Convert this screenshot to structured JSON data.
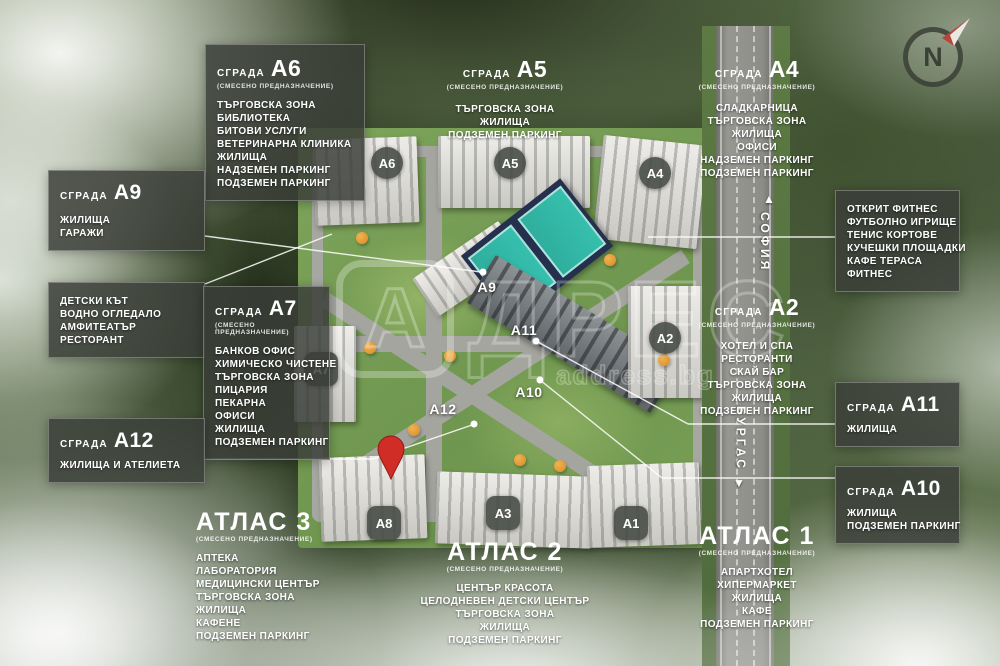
{
  "brand": {
    "logo_letter": "А",
    "watermark_rest": "ДРЕС",
    "watermark_domain": "address.bg",
    "compass_letter": "N"
  },
  "road": {
    "to_sofia": "СОФИЯ",
    "to_burgas": "БУРГАС",
    "sofia_arrow": "▲",
    "burgas_arrow": "▼"
  },
  "colors": {
    "pin_red": "#cf2d26",
    "panel_bg": "rgba(58,62,56,0.84)",
    "court_teal": "#2fae9d"
  },
  "markers": {
    "badges": [
      "A6",
      "A5",
      "A4",
      "A2",
      "A7",
      "A8",
      "A3",
      "A1"
    ],
    "labels": [
      "A9",
      "A11",
      "A10",
      "A12"
    ]
  },
  "panels": {
    "a6": {
      "kicker": "СГРАДА",
      "code": "A6",
      "note": "(СМЕСЕНО ПРЕДНАЗНАЧЕНИЕ)",
      "items": [
        "ТЪРГОВСКА ЗОНА",
        "БИБЛИОТЕКА",
        "БИТОВИ УСЛУГИ",
        "ВЕТЕРИНАРНА КЛИНИКА",
        "ЖИЛИЩА",
        "НАДЗЕМЕН ПАРКИНГ",
        "ПОДЗЕМЕН ПАРКИНГ"
      ]
    },
    "a5": {
      "kicker": "СГРАДА",
      "code": "A5",
      "note": "(СМЕСЕНО ПРЕДНАЗНАЧЕНИЕ)",
      "items": [
        "ТЪРГОВСКА ЗОНА",
        "ЖИЛИЩА",
        "ПОДЗЕМЕН ПАРКИНГ"
      ]
    },
    "a4": {
      "kicker": "СГРАДА",
      "code": "A4",
      "note": "(СМЕСЕНО ПРЕДНАЗНАЧЕНИЕ)",
      "items": [
        "СЛАДКАРНИЦА",
        "ТЪРГОВСКА ЗОНА",
        "ЖИЛИЩА",
        "ОФИСИ",
        "НАДЗЕМЕН ПАРКИНГ",
        "ПОДЗЕМЕН ПАРКИНГ"
      ]
    },
    "a9": {
      "kicker": "СГРАДА",
      "code": "A9",
      "items": [
        "ЖИЛИЩА",
        "ГАРАЖИ"
      ]
    },
    "amenities_west": {
      "items": [
        "ДЕТСКИ КЪТ",
        "ВОДНО ОГЛЕДАЛО",
        "АМФИТЕАТЪР",
        "РЕСТОРАНТ"
      ]
    },
    "a7": {
      "kicker": "СГРАДА",
      "code": "A7",
      "note": "(СМЕСЕНО ПРЕДНАЗНАЧЕНИЕ)",
      "items": [
        "БАНКОВ ОФИС",
        "ХИМИЧЕСКО ЧИСТЕНЕ",
        "ТЪРГОВСКА ЗОНА",
        "ПИЦАРИЯ",
        "ПЕКАРНА",
        "ОФИСИ",
        "ЖИЛИЩА",
        "ПОДЗЕМЕН ПАРКИНГ"
      ]
    },
    "a12": {
      "kicker": "СГРАДА",
      "code": "A12",
      "items": [
        "ЖИЛИЩА И АТЕЛИЕТА"
      ]
    },
    "a2": {
      "kicker": "СГРАДА",
      "code": "A2",
      "note": "(СМЕСЕНО ПРЕДНАЗНАЧЕНИЕ)",
      "items": [
        "ХОТЕЛ И СПА",
        "РЕСТОРАНТИ",
        "СКАЙ БАР",
        "ТЪРГОВСКА ЗОНА",
        "ЖИЛИЩА",
        "ПОДЗЕМЕН ПАРКИНГ"
      ]
    },
    "a11": {
      "kicker": "СГРАДА",
      "code": "A11",
      "items": [
        "ЖИЛИЩА"
      ]
    },
    "a10": {
      "kicker": "СГРАДА",
      "code": "A10",
      "items": [
        "ЖИЛИЩА",
        "ПОДЗЕМЕН ПАРКИНГ"
      ]
    },
    "amenities_east": {
      "items": [
        "ОТКРИТ ФИТНЕС",
        "ФУТБОЛНО ИГРИЩЕ",
        "ТЕНИС КОРТОВЕ",
        "КУЧЕШКИ ПЛОЩАДКИ",
        "КАФЕ ТЕРАСА",
        "ФИТНЕС"
      ]
    },
    "atlas3": {
      "title": "АТЛАС 3",
      "note": "(СМЕСЕНО ПРЕДНАЗНАЧЕНИЕ)",
      "items": [
        "АПТЕКА",
        "ЛАБОРАТОРИЯ",
        "МЕДИЦИНСКИ ЦЕНТЪР",
        "ТЪРГОВСКА ЗОНА",
        "ЖИЛИЩА",
        "КАФЕНЕ",
        "ПОДЗЕМЕН ПАРКИНГ"
      ]
    },
    "atlas2": {
      "title": "АТЛАС 2",
      "note": "(СМЕСЕНО ПРЕДНАЗНАЧЕНИЕ)",
      "items": [
        "ЦЕНТЪР КРАСОТА",
        "ЦЕЛОДНЕВЕН ДЕТСКИ ЦЕНТЪР",
        "ТЪРГОВСКА ЗОНА",
        "ЖИЛИЩА",
        "ПОДЗЕМЕН ПАРКИНГ"
      ]
    },
    "atlas1": {
      "title": "АТЛАС 1",
      "note": "(СМЕСЕНО ПРЕДНАЗНАЧЕНИЕ)",
      "items": [
        "АПАРТХОТЕЛ",
        "ХИПЕРМАРКЕТ",
        "ЖИЛИЩА",
        "КАФЕ",
        "ПОДЗЕМЕН ПАРКИНГ"
      ]
    }
  }
}
